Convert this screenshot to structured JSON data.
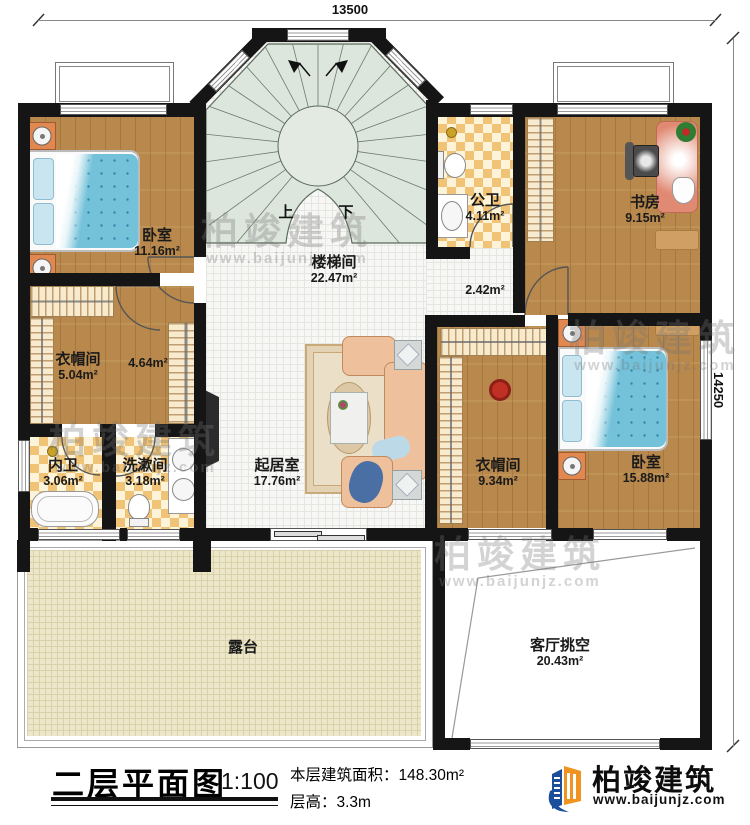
{
  "dimensions": {
    "top": "13500",
    "right": "14250"
  },
  "rooms": {
    "bedroom_left": {
      "name": "卧室",
      "area": "11.16m²"
    },
    "stairwell": {
      "name": "楼梯间",
      "area": "22.47m²"
    },
    "public_bath": {
      "name": "公卫",
      "area": "4.11m²"
    },
    "study": {
      "name": "书房",
      "area": "9.15m²"
    },
    "cloakroom_left": {
      "name": "衣帽间",
      "area": "5.04m²"
    },
    "cloak_corridor": {
      "area": "4.64m²"
    },
    "hall_corridor": {
      "area": "2.42m²"
    },
    "master_bath": {
      "name": "内卫",
      "area": "3.06m²"
    },
    "washroom": {
      "name": "洗漱间",
      "area": "3.18m²"
    },
    "living": {
      "name": "起居室",
      "area": "17.76m²"
    },
    "cloakroom_right": {
      "name": "衣帽间",
      "area": "9.34m²"
    },
    "bedroom_right": {
      "name": "卧室",
      "area": "15.88m²"
    },
    "terrace": {
      "name": "露台"
    },
    "void": {
      "name": "客厅挑空",
      "area": "20.43m²"
    }
  },
  "stairs": {
    "up": "上",
    "down": "下"
  },
  "title_block": {
    "title": "二层平面图",
    "scale": "1:100",
    "floor_area": "本层建筑面积：148.30m²",
    "floor_height": "层高：3.3m"
  },
  "logo": {
    "name": "柏竣建筑",
    "url": "www.baijunjz.com"
  },
  "watermark": {
    "text": "柏竣建筑",
    "url": "www.baijunjz.com"
  },
  "colors": {
    "wall": "#151515",
    "wood": "#b8884c",
    "tile_orange": "#f1c377",
    "stair_green": "#dde6dc",
    "bed_blue": "#74c2da",
    "logo_blue": "#1b4e9b",
    "logo_orange": "#f0931f"
  }
}
